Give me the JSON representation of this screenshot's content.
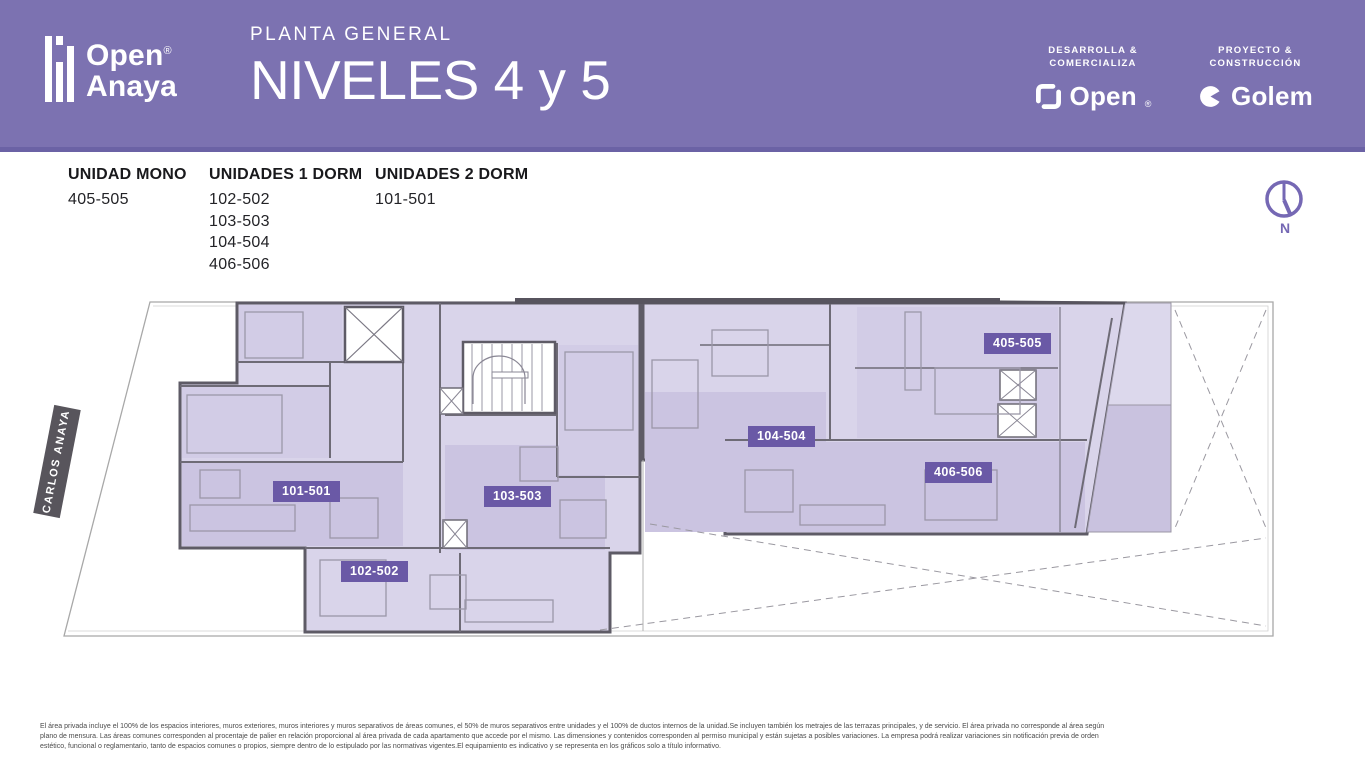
{
  "header": {
    "brand": {
      "line1": "Open",
      "line2": "Anaya",
      "registered": "®"
    },
    "subtitle": "PLANTA GENERAL",
    "title": "NIVELES 4 y 5",
    "developer": {
      "label1": "DESARROLLA &",
      "label2": "COMERCIALIZA",
      "logo": "Open",
      "registered": "®"
    },
    "builder": {
      "label1": "PROYECTO &",
      "label2": "CONSTRUCCIÓN",
      "logo": "Golem"
    }
  },
  "legend": {
    "columns": [
      {
        "title": "UNIDAD MONO",
        "units": [
          "405-505"
        ]
      },
      {
        "title": "UNIDADES 1 DORM",
        "units": [
          "102-502",
          "103-503",
          "104-504",
          "406-506"
        ]
      },
      {
        "title": "UNIDADES 2 DORM",
        "units": [
          "101-501"
        ]
      }
    ]
  },
  "compass": {
    "label": "N"
  },
  "plan": {
    "street": "CARLOS ANAYA",
    "tags": [
      {
        "id": "101-501"
      },
      {
        "id": "102-502"
      },
      {
        "id": "103-503"
      },
      {
        "id": "104-504"
      },
      {
        "id": "405-505"
      },
      {
        "id": "406-506"
      }
    ]
  },
  "footer": {
    "lines": [
      "El área privada incluye el 100% de los espacios interiores, muros exteriores, muros interiores y muros separativos de áreas comunes, el 50% de muros separativos entre unidades y el 100% de ductos internos de la unidad.Se incluyen también los metrajes de las terrazas principales, y de servicio. El área privada no corresponde al área según",
      "plano de mensura. Las áreas comunes corresponden al procentaje de palier en relación proporcional al área privada de cada apartamento que accede por el mismo. Las dimensiones y contenidos corresponden al permiso municipal y están sujetas a posibles variaciones. La empresa podrá realizar variaciones sin notificación previa de orden",
      "estético, funcional o reglamentario, tanto de espacios comunes o propios, siempre dentro de lo estipulado por las normativas vigentes.El equipamiento es indicativo y se representa en los gráficos solo a título informativo."
    ]
  },
  "colors": {
    "header_purple": "#7C72B1",
    "header_band": "#6B62A5",
    "badge_purple": "#6A59A6",
    "compass_purple": "#7568B4",
    "unit_fill_light": "#D9D4EA",
    "unit_fill_dark": "#CBC4E1",
    "street_label_bg": "#58555C"
  }
}
